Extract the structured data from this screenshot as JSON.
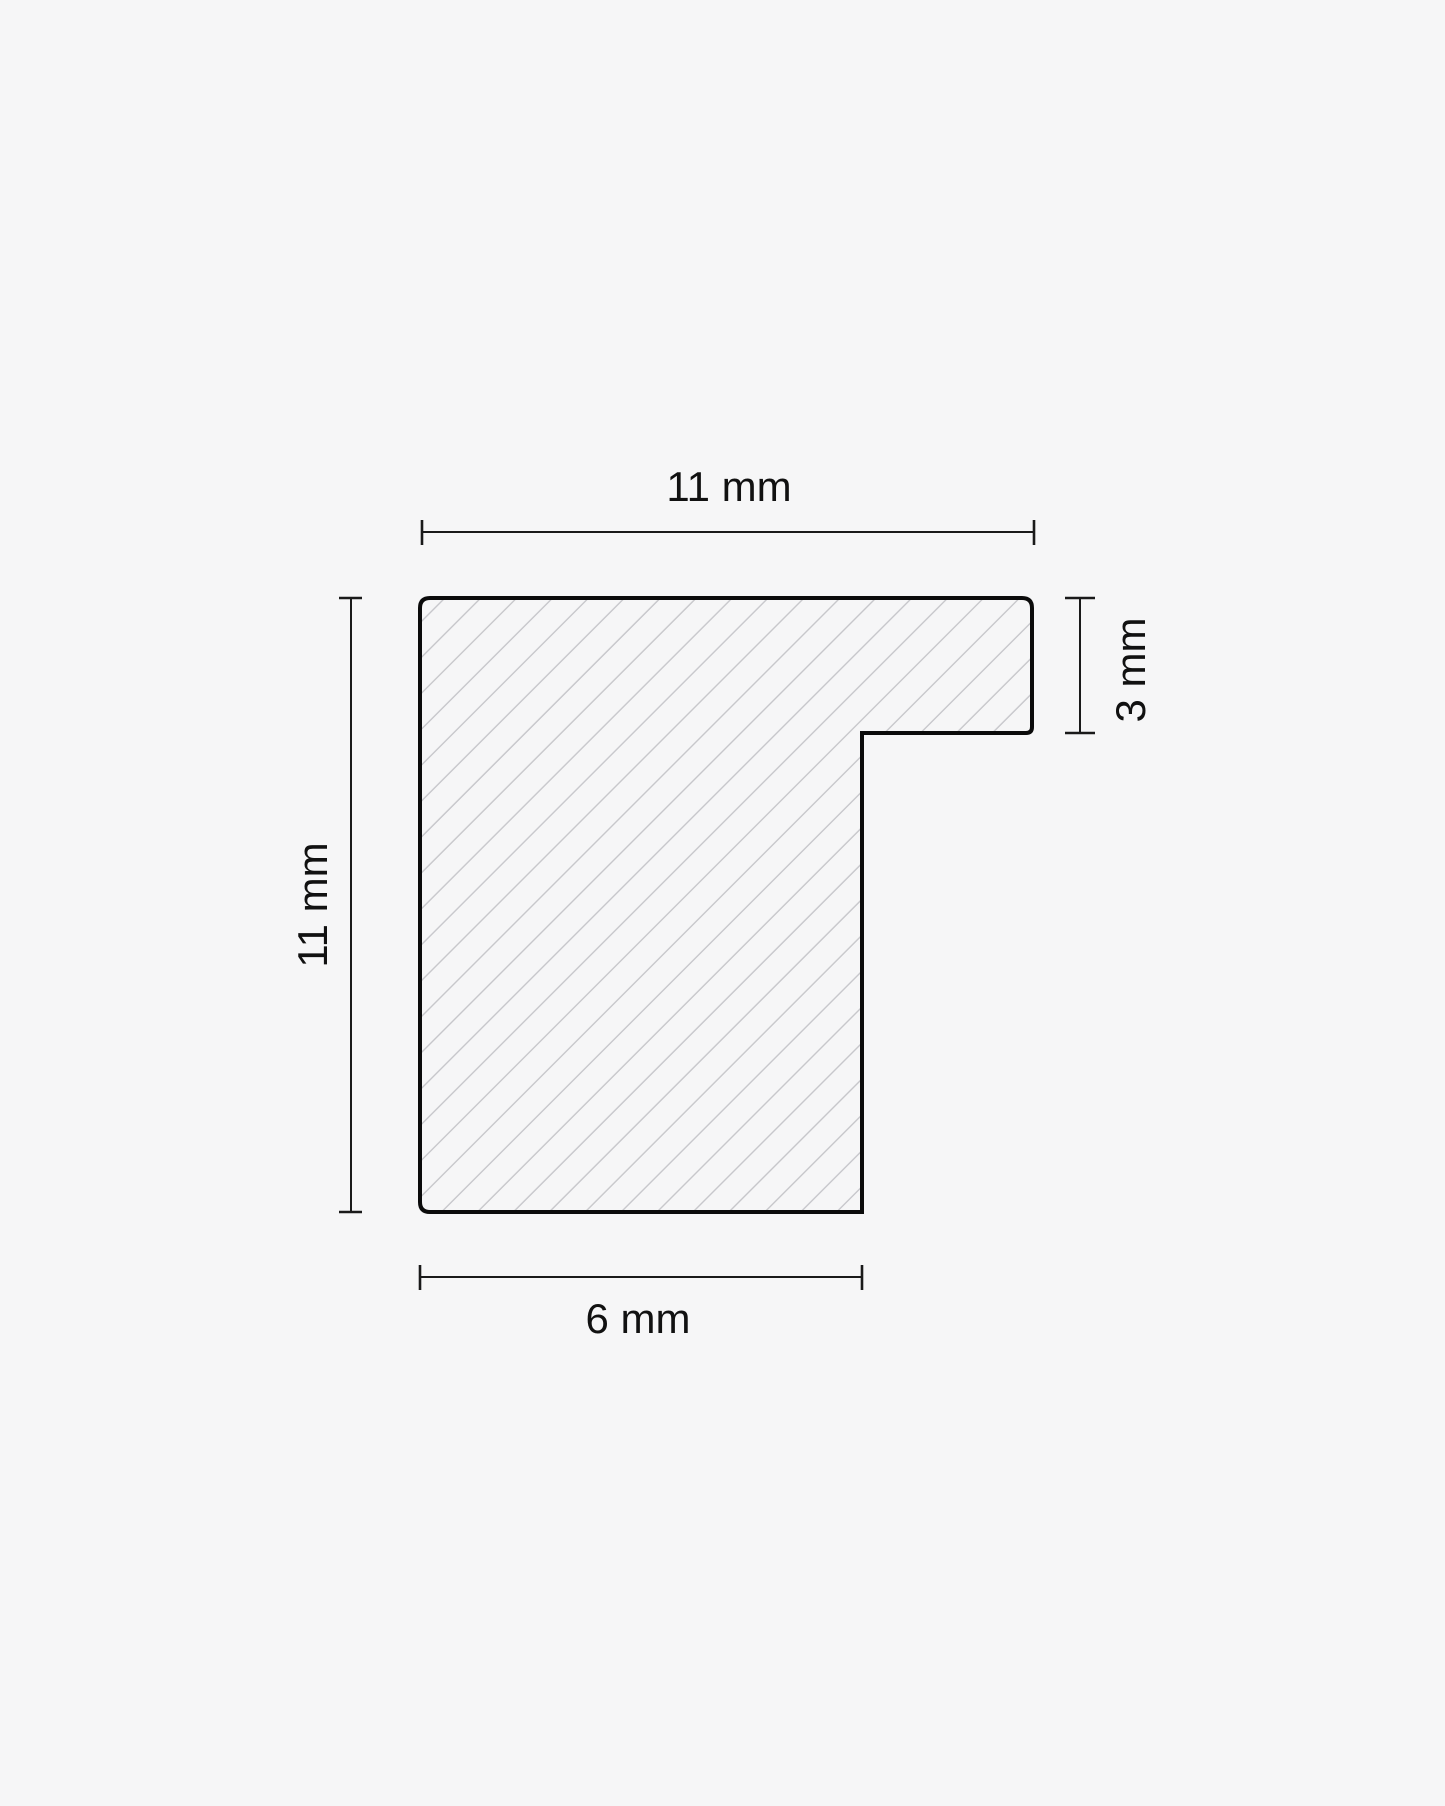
{
  "diagram": {
    "type": "technical-cross-section",
    "subject": "frame-moulding-profile",
    "background_color": "#f6f6f7",
    "colors": {
      "outline": "#0b0b0b",
      "dimension_lines": "#1a1a1a",
      "hatch": "#c6c6ca",
      "label_text": "#111111"
    },
    "dimensions": {
      "top_width": {
        "label": "11 mm",
        "value": 11,
        "unit": "mm"
      },
      "left_height": {
        "label": "11 mm",
        "value": 11,
        "unit": "mm"
      },
      "right_step_height": {
        "label": "3 mm",
        "value": 3,
        "unit": "mm"
      },
      "bottom_width": {
        "label": "6 mm",
        "value": 6,
        "unit": "mm"
      }
    }
  }
}
